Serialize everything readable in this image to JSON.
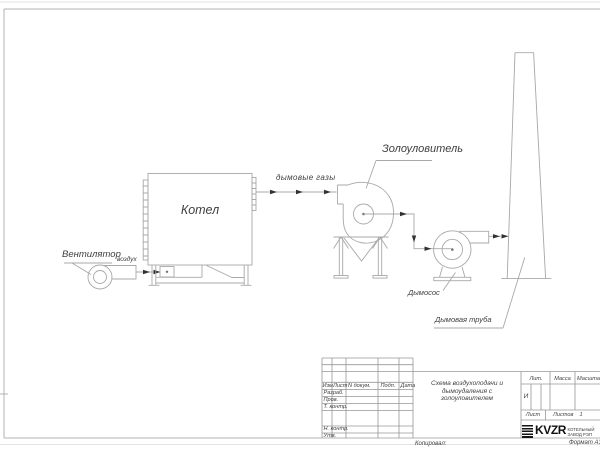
{
  "labels": {
    "fan": "Вентилятор",
    "air": "воздух",
    "boiler": "Котел",
    "flue_gases": "дымовые газы",
    "ash_collector": "Золоуловитель",
    "smoke_exhauster": "Дымосос",
    "chimney": "Дымовая труба"
  },
  "title_block": {
    "revision_header": [
      "Изм.",
      "Лист",
      "N докум.",
      "Подп.",
      "Дата"
    ],
    "signature_rows": [
      "Разраб.",
      "Пров.",
      "Т. контр.",
      "Н. контр.",
      "Утв."
    ],
    "title_lines": [
      "Схема воздухоподачи и",
      "дымоудаления с",
      "золоуловителем"
    ],
    "lit_label": "Лит.",
    "lit_value": "И",
    "mass_label": "Масса",
    "scale_label": "Масштаб",
    "sheet_label": "Лист",
    "sheets_label": "Листов",
    "sheets_value": "1",
    "company_name": "KVZR",
    "company_line1": "КОТЕЛЬНЫЙ",
    "company_line2": "ЗАВОД РЭП",
    "copied_label": "Копировал:",
    "format_label": "Формат А3"
  },
  "colors": {
    "drawing_line": "#a8a8a8",
    "frame_line": "#b3b3b3",
    "text": "#3f3f3f",
    "arrow": "#323232",
    "brand_black": "#151515"
  }
}
